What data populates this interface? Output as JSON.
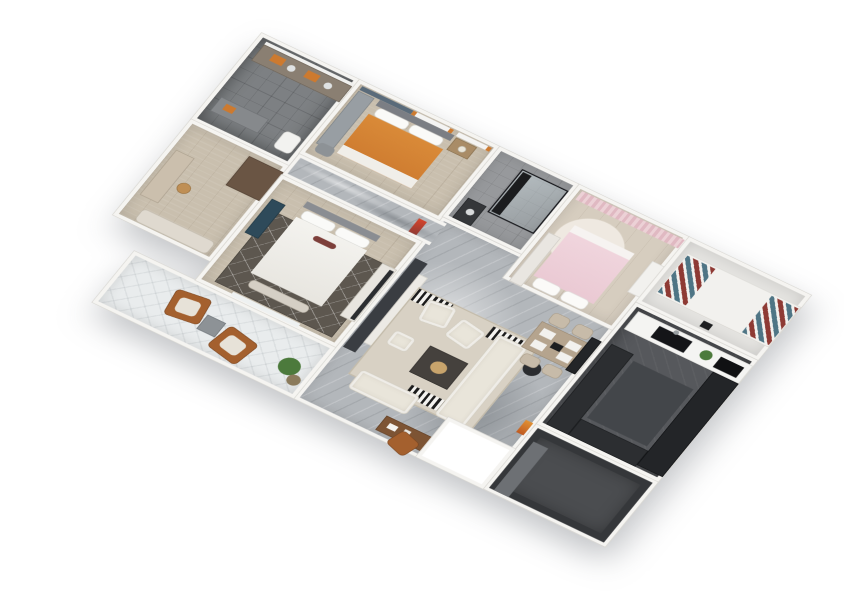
{
  "scene": {
    "type": "3d-floor-plan-render",
    "description": "Isometric top-down 3D rendering of a four-room apartment, rotated about 32 degrees, white exterior background",
    "background": "#ffffff"
  },
  "palette": {
    "wall": "#f5f4f1",
    "wallEdge": "#d9d7d2",
    "marble": "#b3b7bb",
    "wood": "#c9bfae",
    "woodLight": "#d6cdbf",
    "tileDark": "#7d8083",
    "tileMid": "#97999c",
    "floorLight": "#e4e3e0",
    "kitchenFloor": "#56585c",
    "balconyLight": "#e9eced",
    "balconyDark": "#4b4d50",
    "orange": "#cd7a2f",
    "pink": "#eac9d3",
    "pinkCurtain": "#ecd1d6",
    "teal": "#4f7585",
    "red": "#8e3a34",
    "cream": "#e9e5da",
    "rugBeige": "#d8d1c4",
    "rugDark": "#5d574f",
    "leather": "#a4602e",
    "dark": "#232528",
    "media": "#3a3d42",
    "tealCab": "#2e4a5a",
    "green": "#4c7a3c",
    "white": "#f6f5f3",
    "grayMid": "#8d9296"
  },
  "rooms": {
    "living": {
      "label": "Living and dining area, gray marble floor",
      "items": [
        "media wall",
        "TV console",
        "beige area rug",
        "black-white striped accent rugs",
        "two cream accent armchairs",
        "cream sectional sofa",
        "loveseat",
        "ottoman",
        "dark coffee table with brass tray",
        "round side table",
        "writing desk",
        "leather desk chair",
        "orange decor vase",
        "wood dining table",
        "four dining chairs",
        "black sideboard"
      ]
    },
    "corridor": {
      "label": "Hallway with marble floor",
      "items": [
        "red wall art"
      ]
    },
    "bathMain": {
      "label": "Bathroom with double vanity",
      "items": [
        "vanity counter",
        "mirror",
        "orange towels",
        "second counter",
        "toilet"
      ]
    },
    "dressing": {
      "label": "Dressing room / study",
      "items": [
        "dark wardrobe cabinet",
        "vanity counter",
        "round stool",
        "bench"
      ]
    },
    "bedroomOrange": {
      "label": "Bedroom with orange duvet bed",
      "items": [
        "double bed, orange duvet",
        "nightstand",
        "table lamp",
        "wardrobe",
        "windows with orange curtains",
        "blue-gray accent wall",
        "gray ottoman"
      ]
    },
    "master": {
      "label": "Master bedroom",
      "items": [
        "double bed, white duvet",
        "dark patterned rug",
        "teal shelving unit",
        "TV console",
        "foot bench",
        "balcony window"
      ]
    },
    "shower": {
      "label": "Shower room",
      "items": [
        "black-framed glass shower",
        "black rack",
        "dark vanity"
      ]
    },
    "bedroomPink": {
      "label": "Bedroom with pink bed",
      "items": [
        "bed with pink duvet",
        "pink curtains",
        "round cream rug",
        "wardrobe",
        "dresser"
      ]
    },
    "multi": {
      "label": "Multipurpose room with daybed",
      "items": [
        "white daybed",
        "teal-red striped cushions",
        "floor tablet"
      ]
    },
    "kitchen": {
      "label": "Kitchen, dark cabinetry",
      "items": [
        "white counter with black sink",
        "cooktop",
        "potted plant",
        "tall dark cabinet column",
        "L-shaped dark counter",
        "dark floor mat"
      ]
    },
    "balconyLounge": {
      "label": "Lounge balcony",
      "items": [
        "two caramel leather armchairs",
        "gray cube side table",
        "potted plants"
      ]
    },
    "balconyService": {
      "label": "Service balcony, dark walls",
      "items": [
        "dark parapet",
        "entry step"
      ]
    }
  }
}
